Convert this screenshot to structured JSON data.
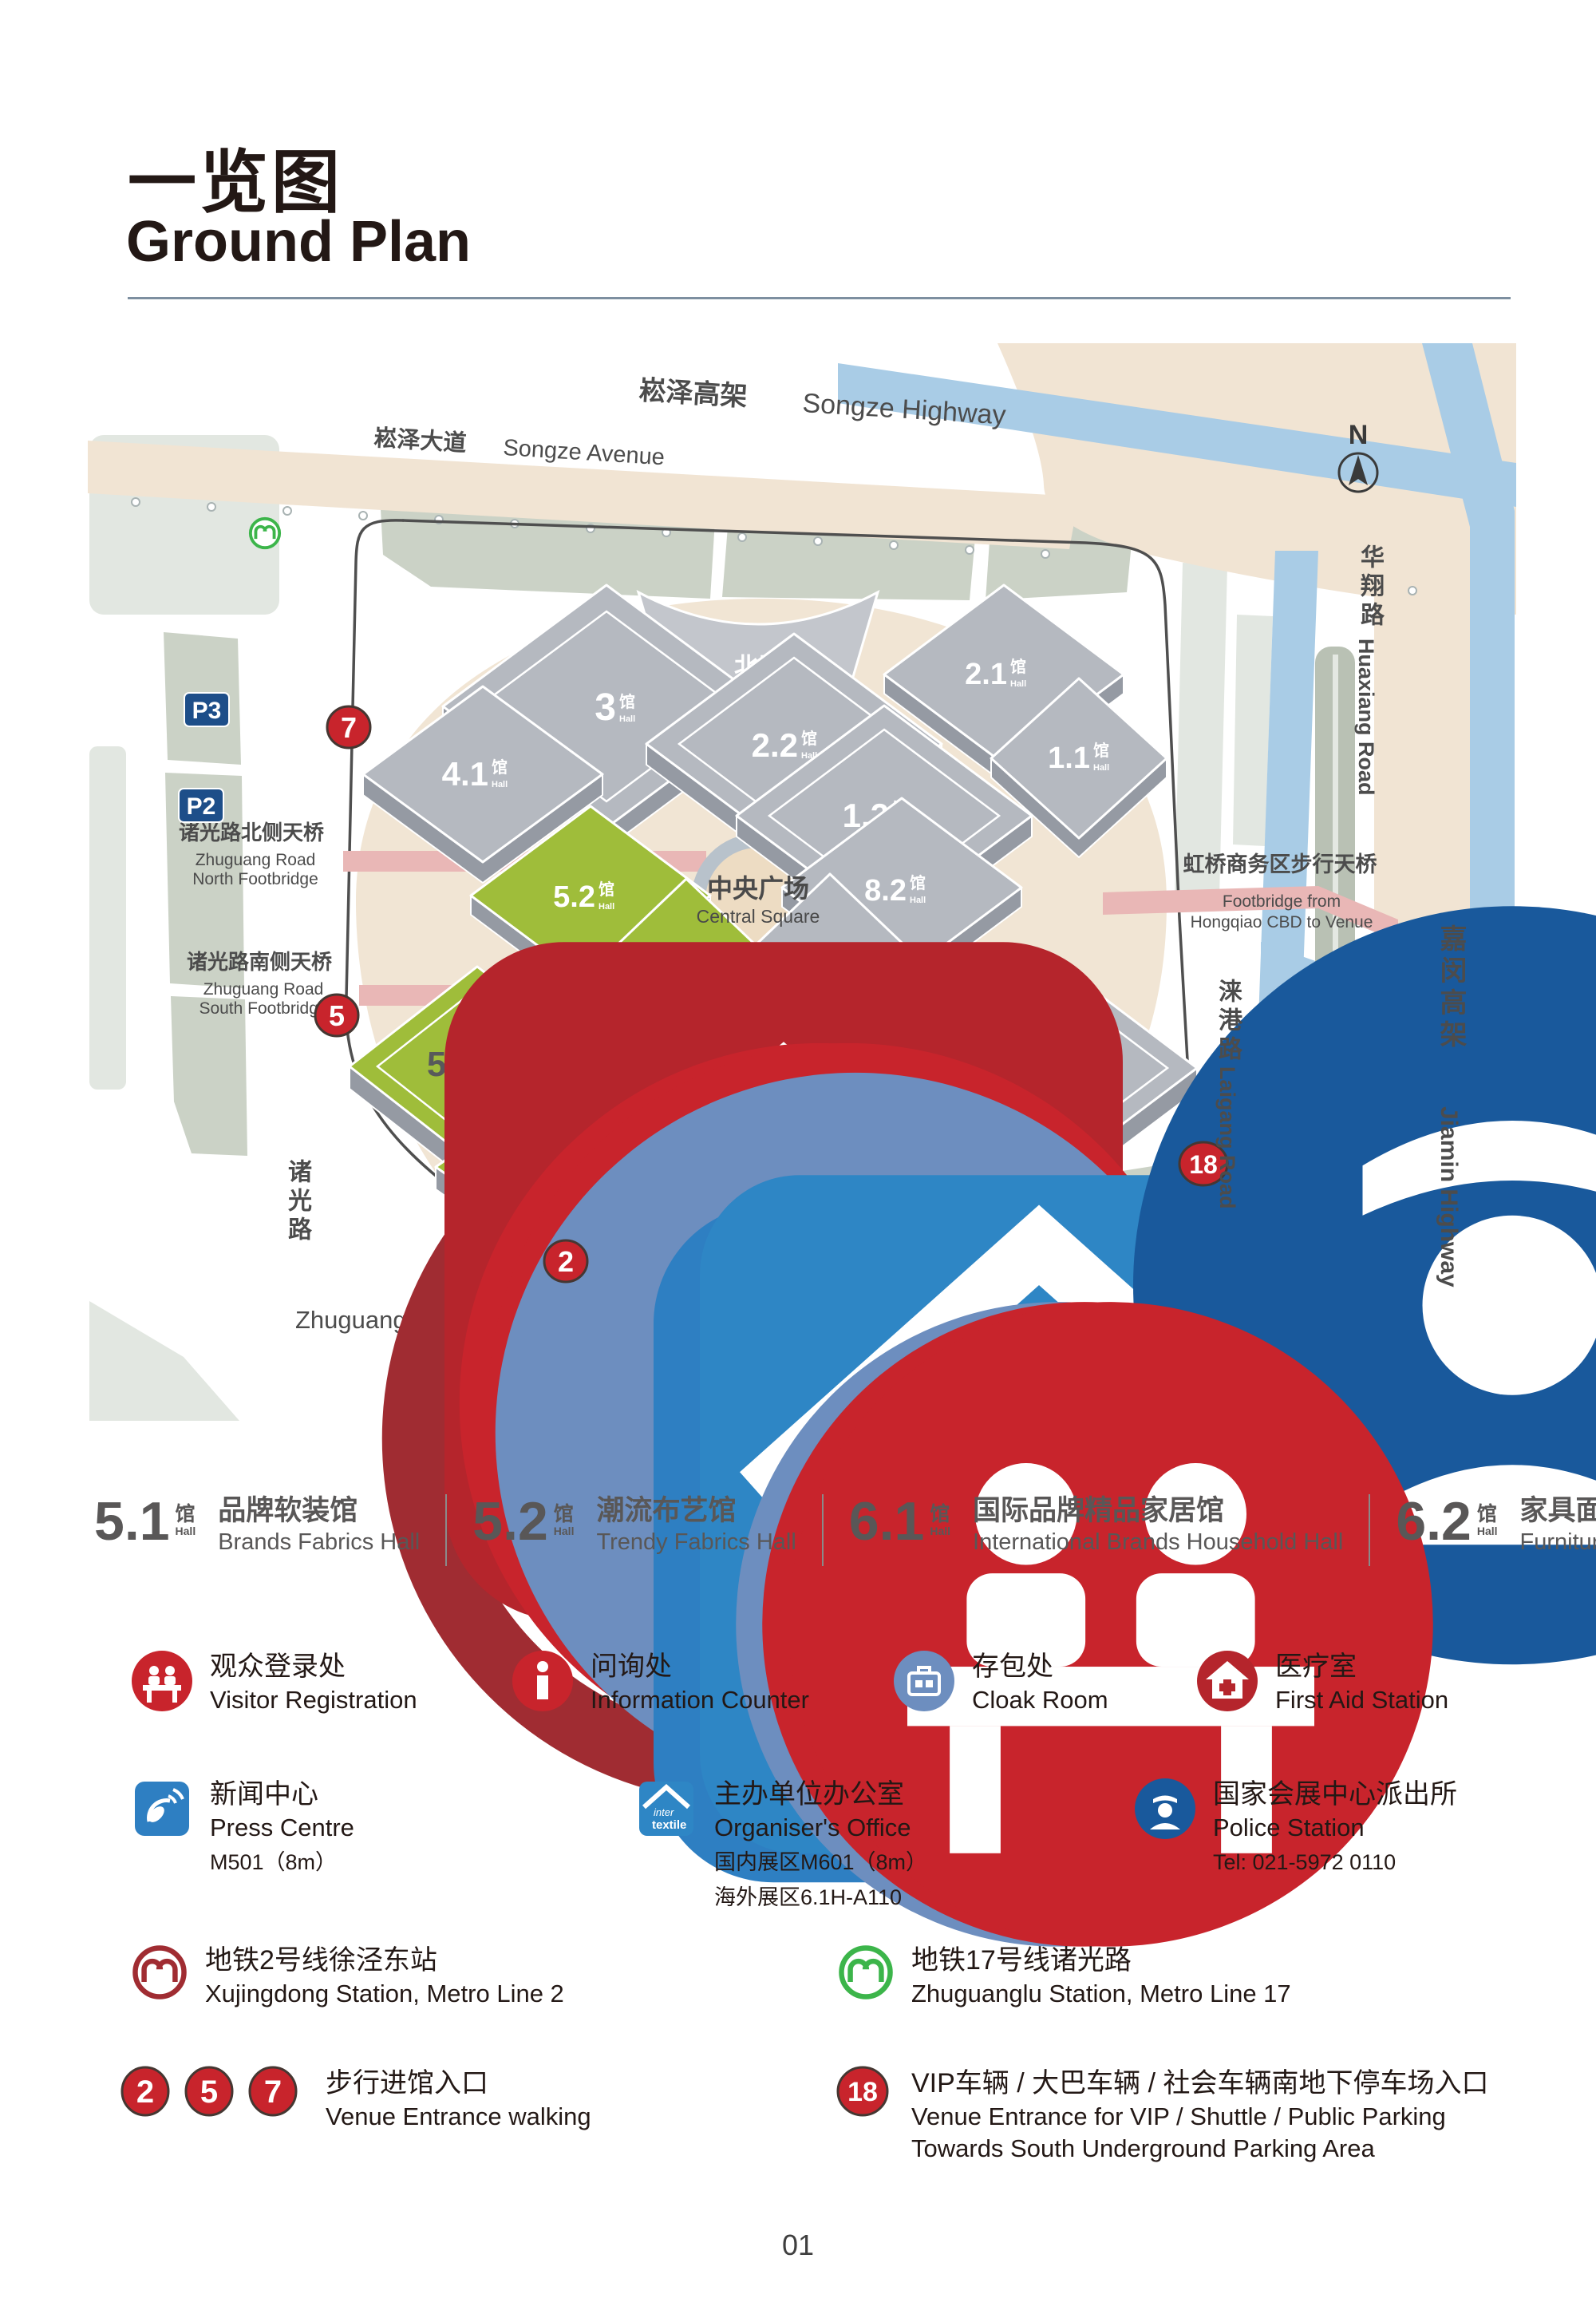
{
  "header": {
    "title_cn": "一览图",
    "title_en": "Ground Plan"
  },
  "map": {
    "compass_n": "N",
    "roads": {
      "songze_highway_cn": "崧泽高架",
      "songze_highway_en": "Songze Highway",
      "songze_avenue_cn": "崧泽大道",
      "songze_avenue_en": "Songze Avenue",
      "huaxiang_cn": "华翔路",
      "huaxiang_en": "Huaxiang Road",
      "jiamin_cn": "嘉闵高架",
      "jiamin_en": "Jiamin Highway",
      "laigang_cn": "涞港路",
      "laigang_en": "Laigang Road",
      "zhuguang_cn": "诸光路",
      "zhuguang_en": "Zhuguang Road",
      "yinggang_cn": "盈港东路",
      "yinggang_en": "Yinggang East Road"
    },
    "halls": {
      "h11": "1.1",
      "h12": "1.2",
      "h21": "2.1",
      "h22": "2.2",
      "h3": "3",
      "h41": "4.1",
      "h51": "5.1",
      "h52": "5.2",
      "h61": "6.1",
      "h62": "6.2",
      "h71": "7.1",
      "h72": "7.2",
      "h81": "8.1",
      "h82": "8.2",
      "suffix_cn": "馆",
      "suffix_en": "Hall"
    },
    "areas": {
      "north_hall_cn": "北厅",
      "north_hall_en": "North Hall",
      "central_cn": "中央广场",
      "central_en": "Central Square",
      "south_square_cn": "南广场",
      "south_square_en": "South Square"
    },
    "footbridges": {
      "north_cn": "诸光路北侧天桥",
      "north_en1": "Zhuguang Road",
      "north_en2": "North Footbridge",
      "south_cn": "诸光路南侧天桥",
      "south_en1": "Zhuguang Road",
      "south_en2": "South Footbridge",
      "hongqiao_cn": "虹桥商务区步行天桥",
      "hongqiao_en1": "Footbridge from",
      "hongqiao_en2": "Hongqiao CBD to Venue"
    },
    "parking": {
      "p": "P",
      "p2": "P2",
      "p3": "P3",
      "shuttle_cn": "大巴车辆停车场",
      "shuttle_en": "Shuttle bus parking",
      "south_underground_cn": "南地下停车场",
      "south_underground_en": "South Underground Parking",
      "vip_cn": "VIP车辆停车场",
      "vip_en": "VIP Parking"
    },
    "markers": {
      "m2": "2",
      "m5": "5",
      "m7": "7",
      "m18": "18"
    }
  },
  "hall_legend": [
    {
      "num": "5.1",
      "name_cn": "品牌软装馆",
      "name_en": "Brands Fabrics Hall"
    },
    {
      "num": "5.2",
      "name_cn": "潮流布艺馆",
      "name_en": "Trendy Fabrics Hall"
    },
    {
      "num": "6.1",
      "name_cn": "国际品牌精品家居馆",
      "name_en": "International Brands Household Hall"
    },
    {
      "num": "6.2",
      "name_cn": "家具面料馆",
      "name_en": "Furniture Fabrics Hall"
    }
  ],
  "facilities": {
    "visitor": {
      "cn": "观众登录处",
      "en": "Visitor Registration"
    },
    "info": {
      "cn": "问询处",
      "en": "Information Counter"
    },
    "cloak": {
      "cn": "存包处",
      "en": "Cloak Room"
    },
    "first_aid": {
      "cn": "医疗室",
      "en": "First Aid Station"
    },
    "press": {
      "cn": "新闻中心",
      "en": "Press Centre",
      "note": "M501（8m）"
    },
    "organiser": {
      "cn": "主办单位办公室",
      "en": "Organiser's Office",
      "note1": "国内展区M601（8m）",
      "note2": "海外展区6.1H-A110"
    },
    "police": {
      "cn": "国家会展中心派出所",
      "en": "Police Station",
      "note": "Tel: 021-5972 0110"
    }
  },
  "metro": {
    "line2": {
      "cn": "地铁2号线徐泾东站",
      "en": "Xujingdong Station, Metro Line 2"
    },
    "line17": {
      "cn": "地铁17号线诸光路",
      "en": "Zhuguanglu Station, Metro Line 17"
    }
  },
  "entrances": {
    "walk": {
      "cn": "步行进馆入口",
      "en": "Venue Entrance walking"
    },
    "vip": {
      "cn": "VIP车辆 / 大巴车辆 / 社会车辆南地下停车场入口",
      "en1": "Venue Entrance for VIP / Shuttle / Public Parking",
      "en2": "Towards South Underground Parking Area"
    }
  },
  "page_number": "01",
  "colors": {
    "entrance_red": "#c8242c",
    "parking_blue": "#1d4e89",
    "water_blue": "#a9cce6",
    "highway_beige": "#f1e4d3",
    "hall_grey": "#b5b9c0",
    "hall_green": "#9fbd3a",
    "metro_red": "#a02c32",
    "metro_green": "#3cb54a",
    "footbridge_pink": "#e9b7b6"
  }
}
